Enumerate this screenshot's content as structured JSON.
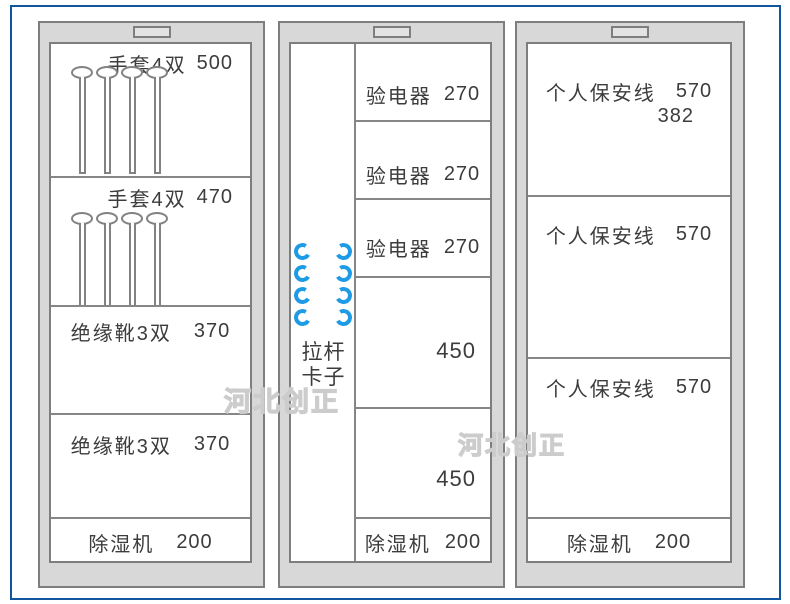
{
  "diagram_title": "safety tool cabinet layout",
  "colors": {
    "frame_blue": "#10559e",
    "cabinet_gray": "#d8d8d8",
    "outline_gray": "#7e7e7e",
    "clip_blue": "#1e9be6",
    "text": "#3c3c3c",
    "watermark": "#cccccc"
  },
  "watermarks": {
    "first": "河北创正",
    "second": "河北创正"
  },
  "cabinet1": {
    "comp1": {
      "label": "手套4双",
      "value": "500"
    },
    "comp2": {
      "label": "手套4双",
      "value": "470"
    },
    "comp3": {
      "label": "绝缘靴3双",
      "value": "370"
    },
    "comp4": {
      "label": "绝缘靴3双",
      "value": "370"
    },
    "comp5": {
      "label": "除湿机",
      "value": "200"
    }
  },
  "cabinet2": {
    "rod_line1": "拉杆",
    "rod_line2": "卡子",
    "comp1": {
      "label": "验电器",
      "value": "270"
    },
    "comp2": {
      "label": "验电器",
      "value": "270"
    },
    "comp3": {
      "label": "验电器",
      "value": "270"
    },
    "comp4": {
      "value": "450"
    },
    "comp5": {
      "value": "450"
    },
    "comp6": {
      "label": "除湿机",
      "value": "200"
    }
  },
  "cabinet3": {
    "comp1": {
      "label": "个人保安线",
      "value": "570",
      "value2": "382"
    },
    "comp2": {
      "label": "个人保安线",
      "value": "570"
    },
    "comp3": {
      "label": "个人保安线",
      "value": "570"
    },
    "comp4": {
      "label": "除湿机",
      "value": "200"
    }
  }
}
